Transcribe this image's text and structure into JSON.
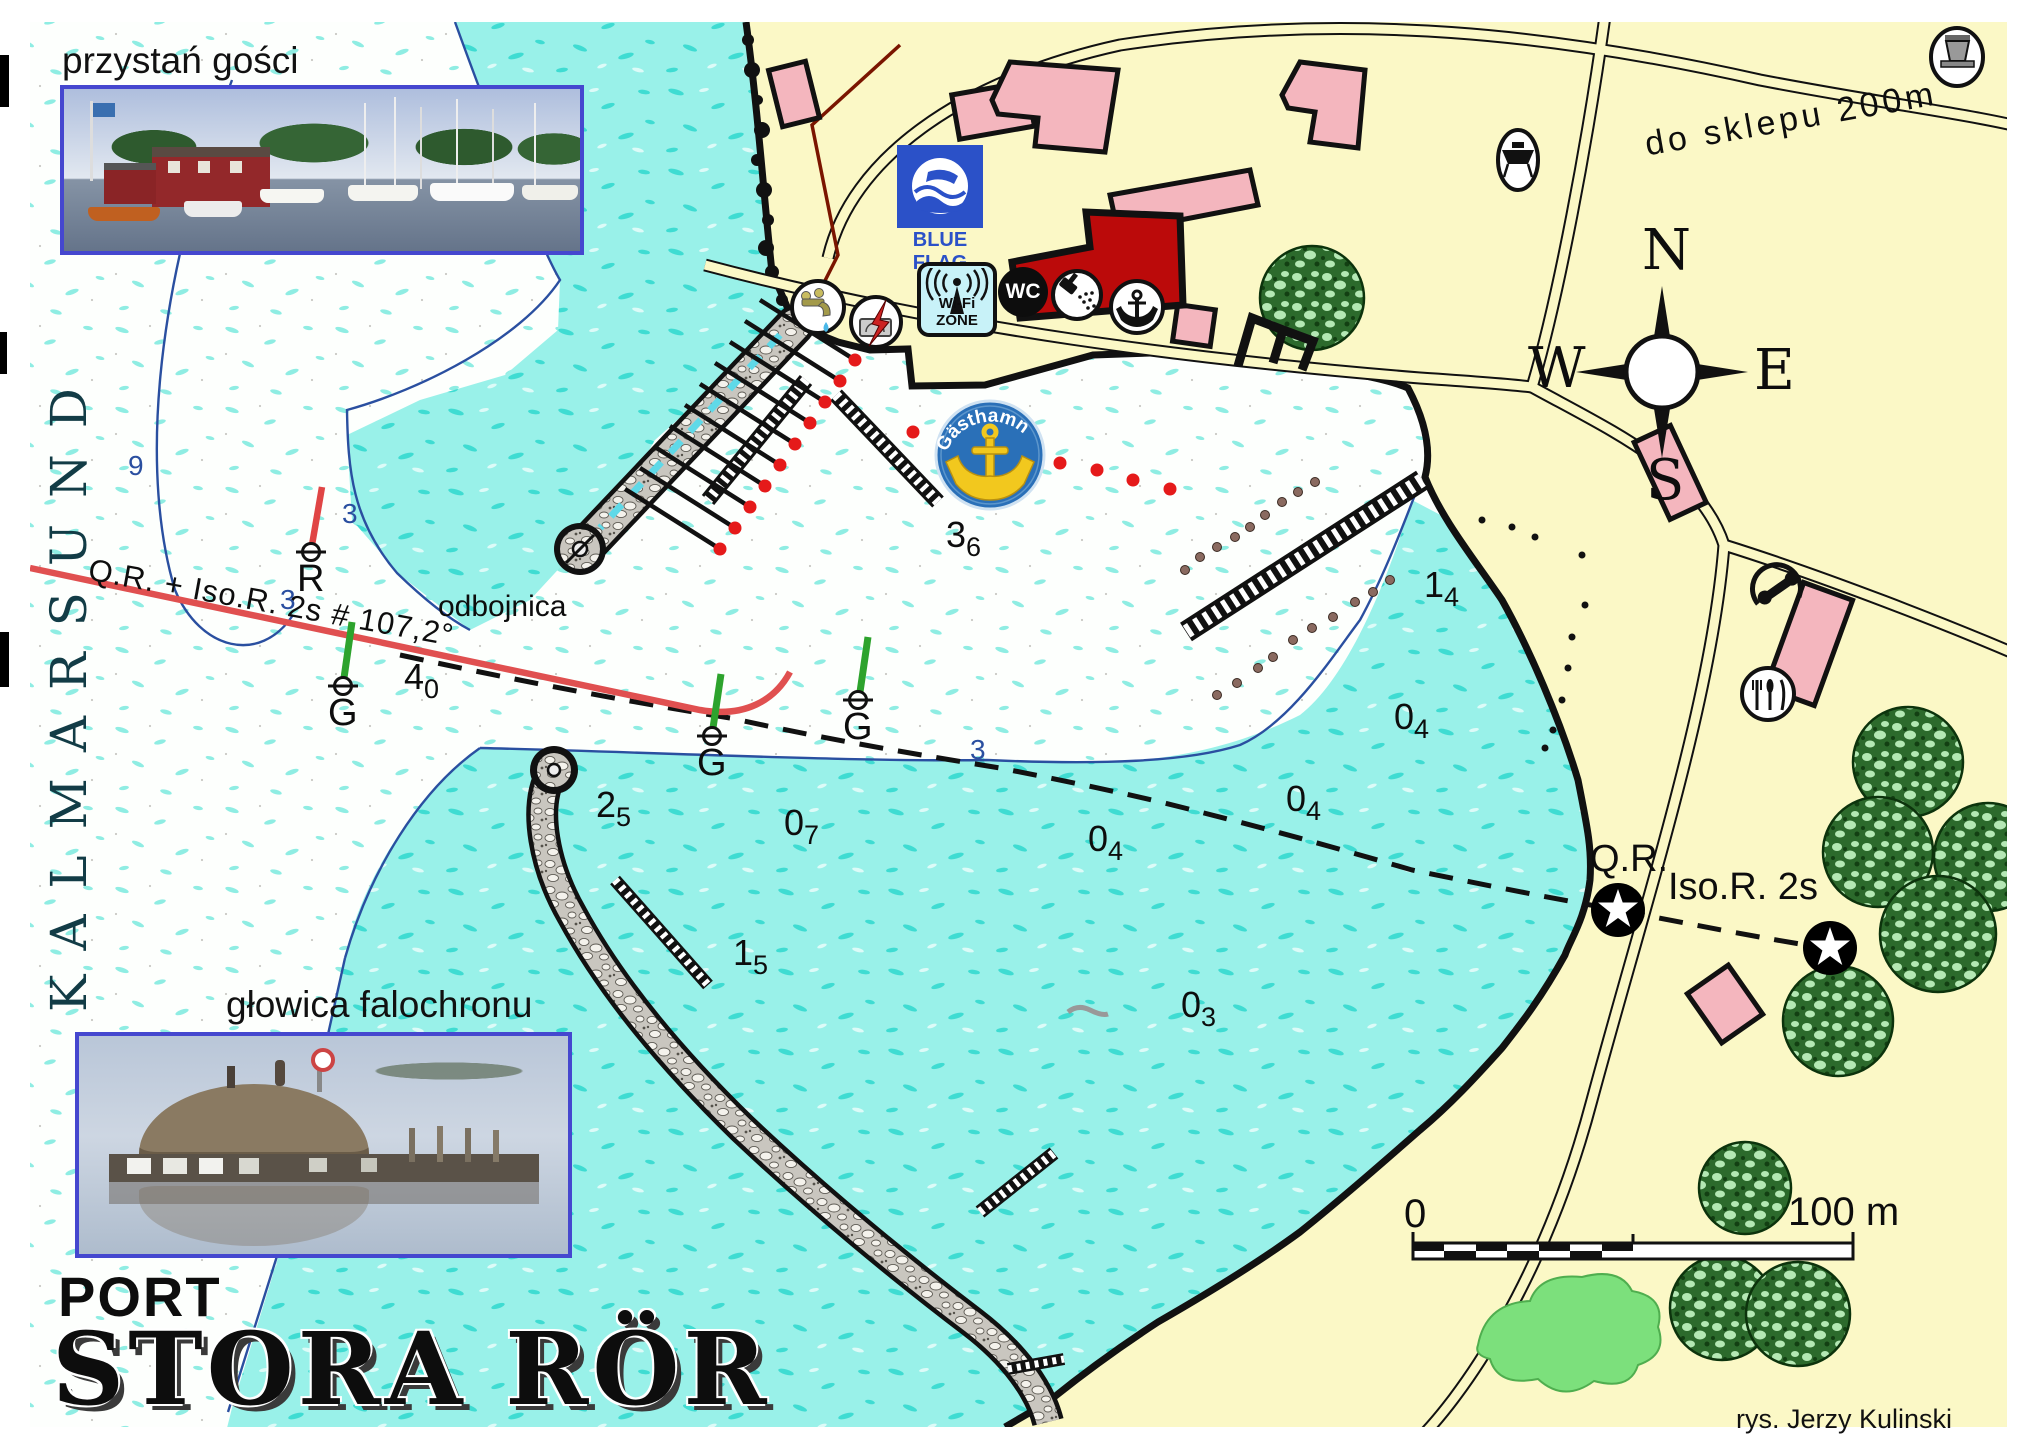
{
  "map": {
    "title": {
      "line1": "PORT",
      "line2": "STORA RÖR"
    },
    "credit": "rys. Jerzy Kulinski",
    "sea_label": "KALMARSUND",
    "road_label": "do sklepu 200m",
    "photos": [
      {
        "caption": "przystań gości"
      },
      {
        "caption": "głowica falochronu"
      }
    ],
    "facility_icons": {
      "wifi_label": "Wi-Fi ZONE",
      "wc_label": "WC",
      "blue_flag_label": "BLUE FLAG",
      "guest_harbour_label": "Gästhamn"
    },
    "navigation": {
      "leading_line_label": "Q.R. + Iso.R. 2s # 107,2°",
      "fender_label": "odbojnica",
      "beacons": [
        {
          "label": "Q.R.",
          "x": 1590,
          "y": 838
        },
        {
          "label": "Iso.R. 2s",
          "x": 1668,
          "y": 866
        }
      ],
      "buoy_labels": [
        {
          "label": "R",
          "x": 297,
          "y": 558
        },
        {
          "label": "G",
          "x": 328,
          "y": 692
        },
        {
          "label": "G",
          "x": 697,
          "y": 742
        },
        {
          "label": "G",
          "x": 843,
          "y": 706
        }
      ]
    },
    "compass": {
      "n": "N",
      "w": "W",
      "e": "E",
      "s": "S"
    },
    "scale_bar": {
      "start": "0",
      "end": "100 m"
    },
    "depths": [
      {
        "whole": "3",
        "frac": "6",
        "x": 946,
        "y": 514
      },
      {
        "whole": "4",
        "frac": "0",
        "x": 404,
        "y": 656
      },
      {
        "whole": "1",
        "frac": "4",
        "x": 1424,
        "y": 564
      },
      {
        "whole": "2",
        "frac": "5",
        "x": 596,
        "y": 784
      },
      {
        "whole": "0",
        "frac": "7",
        "x": 784,
        "y": 802
      },
      {
        "whole": "0",
        "frac": "4",
        "x": 1394,
        "y": 696
      },
      {
        "whole": "0",
        "frac": "4",
        "x": 1286,
        "y": 778
      },
      {
        "whole": "0",
        "frac": "4",
        "x": 1088,
        "y": 818
      },
      {
        "whole": "1",
        "frac": "5",
        "x": 733,
        "y": 932
      },
      {
        "whole": "0",
        "frac": "3",
        "x": 1181,
        "y": 984
      }
    ],
    "contour_depths": [
      {
        "value": "9",
        "x": 128,
        "y": 450
      },
      {
        "value": "3",
        "x": 342,
        "y": 498
      },
      {
        "value": "3",
        "x": 280,
        "y": 584
      },
      {
        "value": "3",
        "x": 970,
        "y": 734
      }
    ]
  }
}
